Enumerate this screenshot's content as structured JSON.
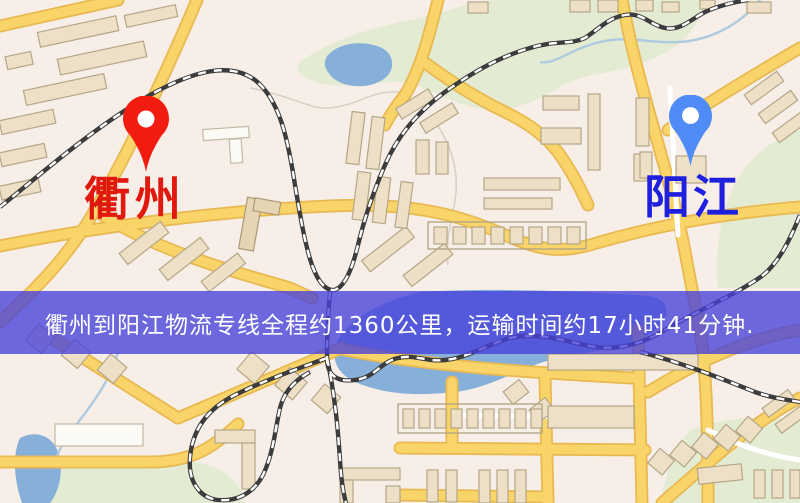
{
  "map": {
    "origin_marker": {
      "label": "衢州",
      "pin_color": "#f21b0f",
      "label_color": "#e0190f"
    },
    "destination_marker": {
      "label": "阳江",
      "pin_color": "#4f8cf7",
      "label_color": "#1f1fe0"
    },
    "banner": {
      "text": "衢州到阳江物流专线全程约1360公里，运输时间约17小时41分钟.",
      "background_color": "#4640da",
      "text_color": "#ffffff"
    },
    "route_info": {
      "from": "衢州",
      "to": "阳江",
      "distance_km": "1360",
      "duration_hours": "17",
      "duration_minutes": "41"
    },
    "palette": {
      "map_background": "#f7efe7",
      "road_fill": "#f9d468",
      "road_casing": "#e8b851",
      "building": "#ede0c6",
      "park": "#e3ebd3",
      "water": "#86afd9",
      "railway": "#3c3c3c"
    }
  }
}
